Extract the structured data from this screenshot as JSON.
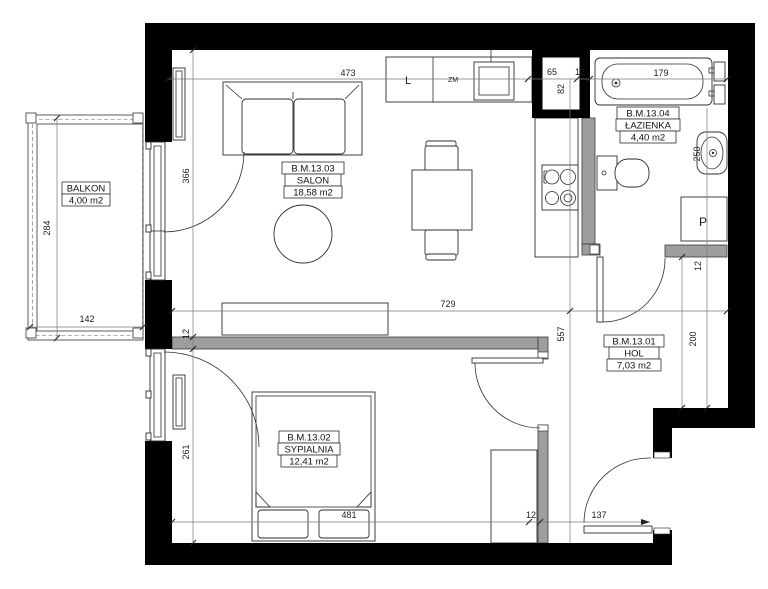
{
  "rooms": {
    "salon": {
      "code": "B.M.13.03",
      "name": "SALON",
      "area": "18,58 m2"
    },
    "sypialnia": {
      "code": "B.M.13.02",
      "name": "SYPIALNIA",
      "area": "12,41 m2"
    },
    "hol": {
      "code": "B.M.13.01",
      "name": "HOL",
      "area": "7,03 m2"
    },
    "lazienka": {
      "code": "B.M.13.04",
      "name": "ŁAZIENKA",
      "area": "4,40 m2"
    },
    "balkon": {
      "name": "BALKON",
      "area": "4,00 m2"
    }
  },
  "fixtures": {
    "fridge": "L",
    "sink": "ZM",
    "washer": "P"
  },
  "dims": {
    "top": {
      "salon": "473",
      "shaft": "65",
      "wall": "12",
      "bath": "179",
      "shaft_h": "82"
    },
    "left": {
      "salon": "366",
      "wall": "12",
      "window": "261"
    },
    "balcony": {
      "depth": "284",
      "width": "142"
    },
    "mid": {
      "width": "729",
      "depth": "557"
    },
    "right": {
      "basin": "250",
      "hol": "200",
      "wall": "12"
    },
    "bottom": {
      "bed": "481",
      "wall": "12",
      "entry": "137"
    }
  },
  "colors": {
    "wall": "#000000",
    "partition": "#9e9e9e",
    "line": "#2e2e2e",
    "background": "#ffffff"
  }
}
